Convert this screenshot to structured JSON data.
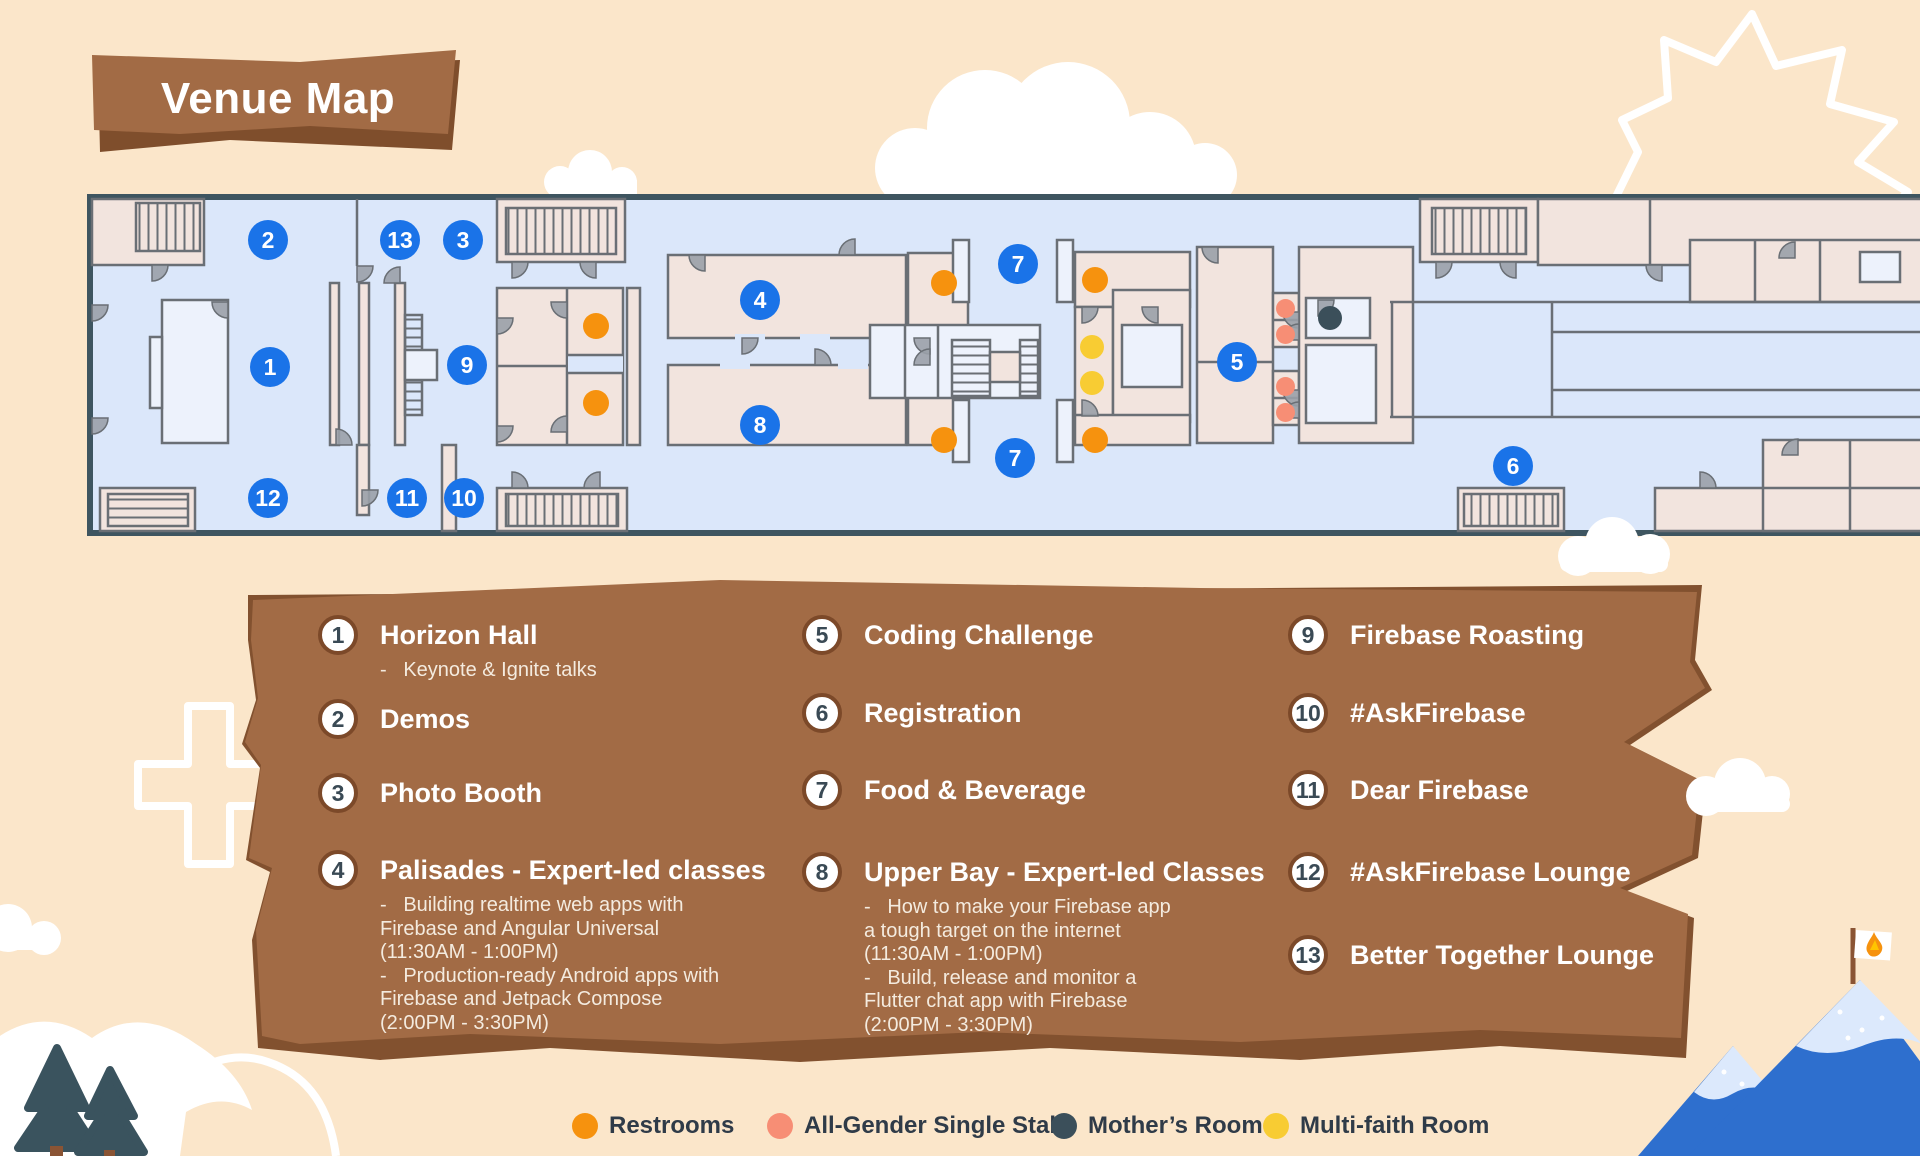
{
  "title": "Venue Map",
  "palette": {
    "background": "#FBE6CA",
    "marker_blue": "#1A73E8",
    "panel_brown": "#A26B45",
    "panel_brown_dark": "#82512F",
    "map_floor": "#DBE7FA",
    "map_room": "#F2E4DE",
    "map_border": "#3E5560",
    "wall_gray": "#6A6F75",
    "legend_circle_border": "#7C4929",
    "legend_number_text": "#3A4A55",
    "legend_detail_text": "#F4EBDF",
    "key_text": "#2F3B48",
    "mountain_blue": "#2E6FCE",
    "snow": "#DCE9FC",
    "tree_green": "#3A535E"
  },
  "dot_colors": {
    "restrooms": "#F6920E",
    "all_gender": "#F78E75",
    "mothers": "#3B4F5A",
    "multi_faith": "#F8CC33"
  },
  "map": {
    "markers": [
      {
        "label": "2",
        "x": 268,
        "y": 240
      },
      {
        "label": "13",
        "x": 400,
        "y": 240
      },
      {
        "label": "3",
        "x": 463,
        "y": 240
      },
      {
        "label": "1",
        "x": 270,
        "y": 367
      },
      {
        "label": "9",
        "x": 467,
        "y": 365
      },
      {
        "label": "12",
        "x": 268,
        "y": 498
      },
      {
        "label": "11",
        "x": 407,
        "y": 498
      },
      {
        "label": "10",
        "x": 464,
        "y": 498
      },
      {
        "label": "4",
        "x": 760,
        "y": 300
      },
      {
        "label": "8",
        "x": 760,
        "y": 425
      },
      {
        "label": "7",
        "x": 1018,
        "y": 264
      },
      {
        "label": "7",
        "x": 1015,
        "y": 458
      },
      {
        "label": "5",
        "x": 1237,
        "y": 362
      },
      {
        "label": "6",
        "x": 1513,
        "y": 466
      }
    ],
    "dots": [
      {
        "type": "restrooms",
        "x": 596,
        "y": 326
      },
      {
        "type": "restrooms",
        "x": 596,
        "y": 403
      },
      {
        "type": "restrooms",
        "x": 944,
        "y": 283
      },
      {
        "type": "restrooms",
        "x": 944,
        "y": 440
      },
      {
        "type": "restrooms",
        "x": 1095,
        "y": 280
      },
      {
        "type": "restrooms",
        "x": 1095,
        "y": 440
      },
      {
        "type": "multi_faith",
        "x": 1092,
        "y": 347
      },
      {
        "type": "multi_faith",
        "x": 1092,
        "y": 383
      },
      {
        "type": "all_gender",
        "x": 1285,
        "y": 308
      },
      {
        "type": "all_gender",
        "x": 1285,
        "y": 334
      },
      {
        "type": "all_gender",
        "x": 1285,
        "y": 386
      },
      {
        "type": "all_gender",
        "x": 1285,
        "y": 412
      },
      {
        "type": "mothers",
        "x": 1330,
        "y": 318
      }
    ]
  },
  "legend": {
    "columns": [
      {
        "x": 318,
        "items": [
          {
            "num": "1",
            "title": "Horizon Hall",
            "y": 635,
            "details": [
              "-   Keynote & Ignite talks"
            ]
          },
          {
            "num": "2",
            "title": "Demos",
            "y": 719,
            "details": []
          },
          {
            "num": "3",
            "title": "Photo Booth",
            "y": 793,
            "details": []
          },
          {
            "num": "4",
            "title": "Palisades - Expert-led classes",
            "y": 870,
            "details": [
              "-   Building realtime web apps with",
              "Firebase and Angular Universal",
              "(11:30AM - 1:00PM)",
              "-   Production-ready Android apps with",
              "Firebase and Jetpack Compose",
              "(2:00PM - 3:30PM)"
            ]
          }
        ]
      },
      {
        "x": 802,
        "items": [
          {
            "num": "5",
            "title": "Coding Challenge",
            "y": 635,
            "details": []
          },
          {
            "num": "6",
            "title": "Registration",
            "y": 713,
            "details": []
          },
          {
            "num": "7",
            "title": "Food & Beverage",
            "y": 790,
            "details": []
          },
          {
            "num": "8",
            "title": "Upper Bay - Expert-led Classes",
            "y": 872,
            "details": [
              "-   How to make your Firebase app",
              "a tough target on the internet",
              "(11:30AM - 1:00PM)",
              "-   Build, release and monitor a",
              "Flutter chat app with Firebase",
              "(2:00PM - 3:30PM)"
            ]
          }
        ]
      },
      {
        "x": 1288,
        "items": [
          {
            "num": "9",
            "title": "Firebase Roasting",
            "y": 635,
            "details": []
          },
          {
            "num": "10",
            "title": "#AskFirebase",
            "y": 713,
            "details": []
          },
          {
            "num": "11",
            "title": "Dear Firebase",
            "y": 790,
            "details": []
          },
          {
            "num": "12",
            "title": "#AskFirebase Lounge",
            "y": 872,
            "details": []
          },
          {
            "num": "13",
            "title": "Better Together Lounge",
            "y": 955,
            "details": []
          }
        ]
      }
    ]
  },
  "key": {
    "y": 1112,
    "items": [
      {
        "type": "restrooms",
        "label": "Restrooms",
        "x": 572
      },
      {
        "type": "all_gender",
        "label": "All-Gender Single Stall",
        "x": 767
      },
      {
        "type": "mothers",
        "label": "Mother’s Room",
        "x": 1051
      },
      {
        "type": "multi_faith",
        "label": "Multi-faith Room",
        "x": 1263
      }
    ]
  }
}
